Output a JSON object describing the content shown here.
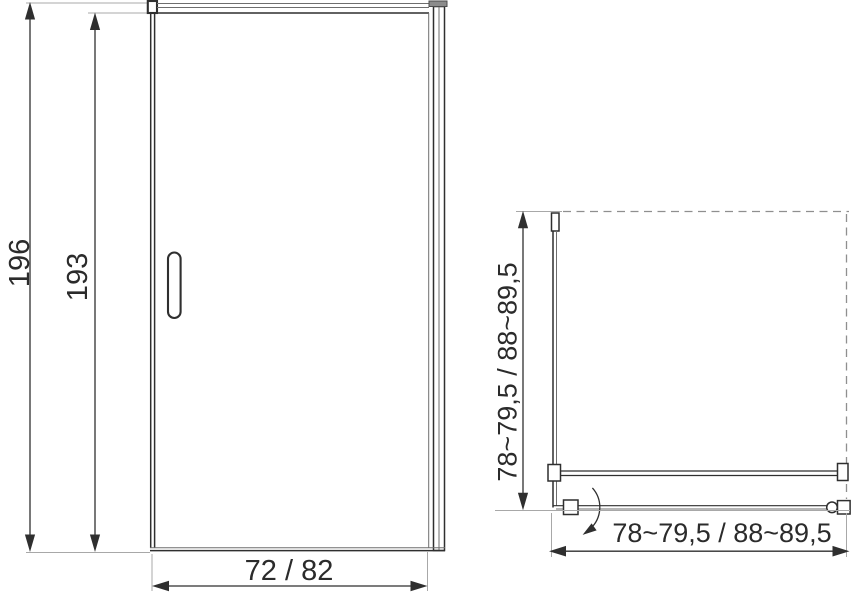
{
  "colors": {
    "line-dark": "#2f2f2f",
    "line-mid": "#6e6e6e",
    "line-ext": "#a8a8a8",
    "line-wall": "#8f8f8f",
    "cap-fill": "#8c8c8c",
    "text": "#2b2b2b"
  },
  "front_view": {
    "label_total_height": "196",
    "label_door_height": "193",
    "label_door_width": "72 / 82"
  },
  "top_view": {
    "label_depth": "78~79,5 / 88~89,5",
    "label_width": "78~79,5 / 88~89,5"
  }
}
